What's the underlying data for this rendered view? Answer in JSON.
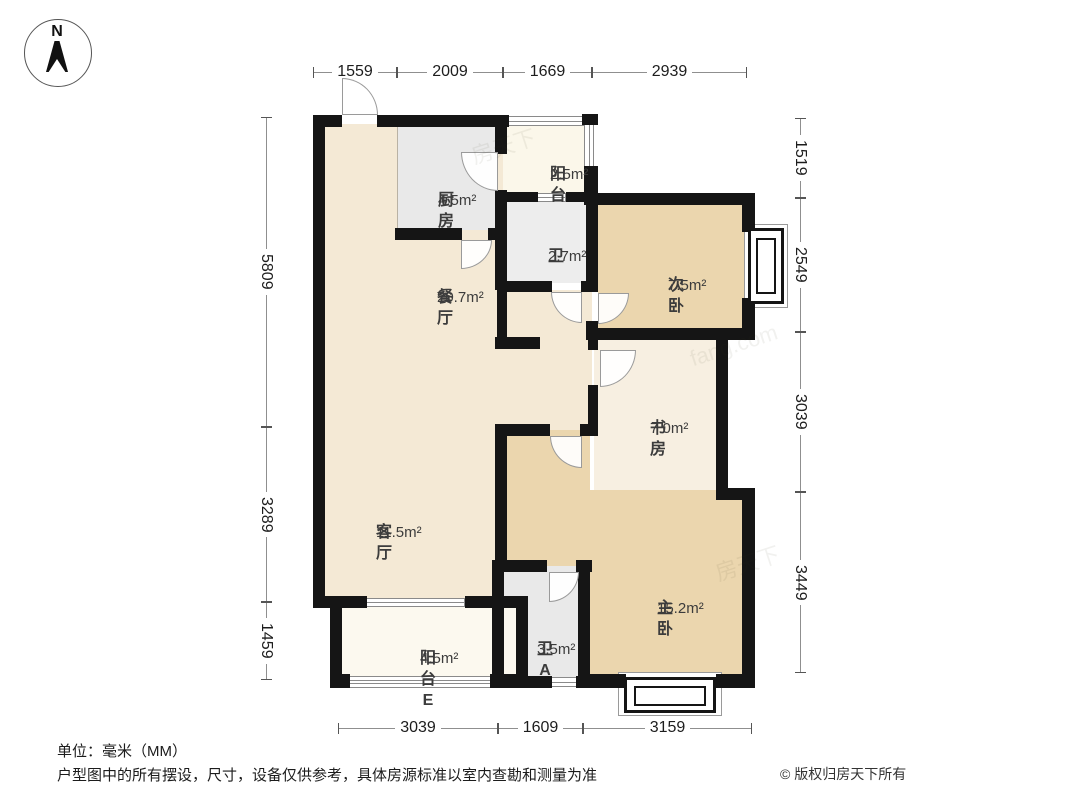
{
  "compass": {
    "label": "N"
  },
  "rooms": [
    {
      "id": "dining",
      "name": "餐厅",
      "area": "20.7m²"
    },
    {
      "id": "kitchen",
      "name": "厨房",
      "area": "4.5m²"
    },
    {
      "id": "balcony_top",
      "name": "阳台",
      "area": "2.5m²"
    },
    {
      "id": "bath",
      "name": "卫",
      "area": "2.7m²"
    },
    {
      "id": "bedroom_second",
      "name": "次卧",
      "area": "7.5m²"
    },
    {
      "id": "study",
      "name": "书房",
      "area": "7.0m²"
    },
    {
      "id": "living",
      "name": "客厅",
      "area": "11.5m²"
    },
    {
      "id": "bedroom_master",
      "name": "主卧",
      "area": "15.2m²"
    },
    {
      "id": "bath_a",
      "name": "卫A",
      "area": "3.5m²"
    },
    {
      "id": "balcony_e",
      "name": "阳台E",
      "area": "4.5m²"
    }
  ],
  "dimensions": {
    "top": [
      "1559",
      "2009",
      "1669",
      "2939"
    ],
    "bottom": [
      "3039",
      "1609",
      "3159"
    ],
    "left": [
      "5809",
      "3289",
      "1459"
    ],
    "right": [
      "1519",
      "2549",
      "3039",
      "3449"
    ]
  },
  "footer": {
    "unit": "单位：毫米（MM）",
    "disclaimer": "户型图中的所有摆设，尺寸，设备仅供参考，具体房源标准以室内查勘和测量为准",
    "copyright": "© 版权归房天下所有"
  },
  "watermarks": [
    "房天下",
    "fang.com",
    "房天下"
  ],
  "colors": {
    "wall": "#151515",
    "open_space": "#f4e9d5",
    "bedroom": "#ebd6ae",
    "study": "#f7efe1",
    "balcony_top": "#fbf7ea",
    "balcony_e": "#fcf9ef",
    "kitchen_gray": "#e9e9e9",
    "bath_gray": "#ededed"
  }
}
